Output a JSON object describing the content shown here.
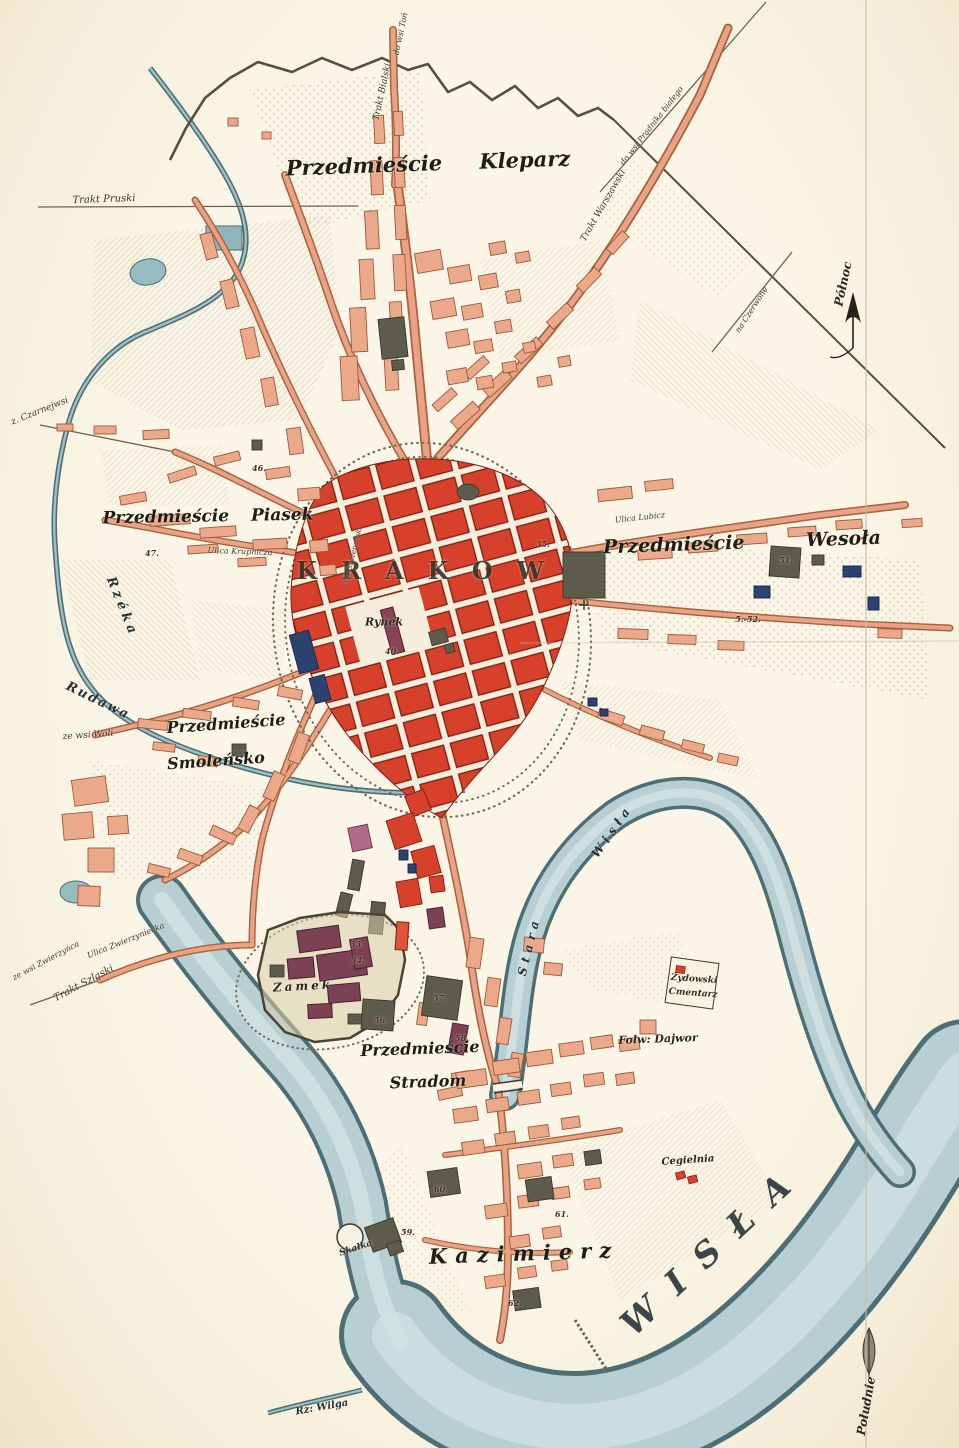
{
  "map_type": "historical city plan of Krakow",
  "colors": {
    "paper": "#f8f2df",
    "old_town_block_red": "#d7402a",
    "suburb_block_salmon": "#eca98a",
    "public_building_grey": "#5d5c4c",
    "castle_purple": "#7c4154",
    "special_block_blue": "#2c4370",
    "river_fill": "#b7cfd2",
    "river_edge": "#4c6e74",
    "ink": "#2b2620"
  },
  "compass": {
    "north": "Północ",
    "south": "Południe"
  },
  "labels": [
    {
      "id": "przedmiescie-kleparz",
      "t": "Przedmieście Kleparz",
      "x": 428,
      "y": 163,
      "r": -2,
      "s": 21,
      "ws": 30,
      "c": "district"
    },
    {
      "id": "przedmiescie-piasek",
      "t": "Przedmieście Piasek",
      "x": 208,
      "y": 517,
      "r": -1,
      "s": 17,
      "ws": 16,
      "c": "district"
    },
    {
      "id": "przedmiescie-wesola",
      "t": "Przedmieście Wesoła",
      "x": 742,
      "y": 543,
      "r": -2,
      "s": 19,
      "ws": 55,
      "c": "district"
    },
    {
      "id": "krakow",
      "t": "KRAKOW",
      "x": 432,
      "y": 571,
      "r": 0,
      "s": 24,
      "ls": 24,
      "c": "city"
    },
    {
      "id": "rynek",
      "t": "Rynek",
      "x": 384,
      "y": 622,
      "r": 0,
      "s": 11,
      "c": "place"
    },
    {
      "id": "smolensko-line1",
      "t": "Przedmieście",
      "x": 226,
      "y": 724,
      "r": -4,
      "s": 16,
      "c": "district"
    },
    {
      "id": "smolensko-line2",
      "t": "Smoleńsko",
      "x": 216,
      "y": 761,
      "r": -4,
      "s": 16,
      "c": "district"
    },
    {
      "id": "stradom-line1",
      "t": "Przedmieście",
      "x": 420,
      "y": 1049,
      "r": -2,
      "s": 16,
      "c": "district"
    },
    {
      "id": "stradom-line2",
      "t": "Stradom",
      "x": 428,
      "y": 1082,
      "r": -2,
      "s": 16,
      "c": "district"
    },
    {
      "id": "kazimierz",
      "t": "Kazimierz",
      "x": 524,
      "y": 1253,
      "r": -2,
      "s": 21,
      "ls": 8,
      "c": "district"
    },
    {
      "id": "zamek",
      "t": "Zamek",
      "x": 303,
      "y": 986,
      "r": -3,
      "s": 12,
      "ls": 3,
      "c": "place"
    },
    {
      "id": "wisla",
      "t": "WISŁA",
      "x": 714,
      "y": 1248,
      "r": -43,
      "s": 34,
      "ls": 22,
      "c": "bigriver"
    },
    {
      "id": "stara-wisla-1",
      "t": "Stara",
      "x": 529,
      "y": 946,
      "r": -76,
      "s": 12,
      "ls": 5,
      "c": "river"
    },
    {
      "id": "stara-wisla-2",
      "t": "Wisła",
      "x": 612,
      "y": 831,
      "r": -55,
      "s": 12,
      "ls": 5,
      "c": "river"
    },
    {
      "id": "rzeka",
      "t": "Rzéka",
      "x": 122,
      "y": 607,
      "r": 68,
      "s": 13,
      "ls": 4,
      "c": "river"
    },
    {
      "id": "rudawa",
      "t": "Rudawa",
      "x": 98,
      "y": 701,
      "r": 26,
      "s": 13,
      "ls": 2,
      "c": "river"
    },
    {
      "id": "rz-wilga",
      "t": "Rz: Wilga",
      "x": 322,
      "y": 1408,
      "r": -10,
      "s": 10,
      "c": "river"
    },
    {
      "id": "polnoc",
      "t": "Północ",
      "x": 843,
      "y": 284,
      "r": -78,
      "s": 12,
      "c": "place"
    },
    {
      "id": "poludnie",
      "t": "Południe",
      "x": 866,
      "y": 1406,
      "r": -80,
      "s": 12,
      "c": "place"
    },
    {
      "id": "trakt-pruski",
      "t": "Trakt Pruski",
      "x": 104,
      "y": 200,
      "r": -2,
      "s": 10,
      "c": "road"
    },
    {
      "id": "trakt-bialski",
      "t": "Trakt Bialski",
      "x": 383,
      "y": 92,
      "r": -78,
      "s": 9,
      "c": "road"
    },
    {
      "id": "do-wsi-ton",
      "t": "do wsi Toń",
      "x": 401,
      "y": 34,
      "r": -78,
      "s": 8,
      "c": "road"
    },
    {
      "id": "do-wsi-pradnika",
      "t": "do wsi Prądnika białego",
      "x": 652,
      "y": 126,
      "r": -52,
      "s": 8,
      "c": "road"
    },
    {
      "id": "trakt-warszawski",
      "t": "Trakt Warszawski",
      "x": 604,
      "y": 206,
      "r": -60,
      "s": 9,
      "c": "road"
    },
    {
      "id": "na-czerwone",
      "t": "na Czerwone",
      "x": 752,
      "y": 310,
      "r": -57,
      "s": 8,
      "c": "road"
    },
    {
      "id": "z-czarnejwsi",
      "t": "z. Czarnejwsi",
      "x": 40,
      "y": 412,
      "r": -22,
      "s": 9,
      "c": "road"
    },
    {
      "id": "ze-wsi-woli",
      "t": "ze wsi Woli",
      "x": 88,
      "y": 736,
      "r": -4,
      "s": 9,
      "c": "road"
    },
    {
      "id": "ze-wsi-zwierzynca",
      "t": "ze wsi Zwierzyńca",
      "x": 46,
      "y": 961,
      "r": -28,
      "s": 8,
      "c": "road"
    },
    {
      "id": "trakt-szlaski",
      "t": "Trakt Szląski",
      "x": 84,
      "y": 984,
      "r": -28,
      "s": 10,
      "c": "road"
    },
    {
      "id": "ulica-zwierzyniecka",
      "t": "Ulica Zwierzyniecka",
      "x": 126,
      "y": 941,
      "r": -22,
      "s": 8,
      "c": "road"
    },
    {
      "id": "ulica-lubicz",
      "t": "Ulica Lubicz",
      "x": 640,
      "y": 518,
      "r": -6,
      "s": 8,
      "c": "road"
    },
    {
      "id": "ulica-krupnicza",
      "t": "Ulica Krupnicza",
      "x": 240,
      "y": 552,
      "r": 2,
      "s": 8,
      "c": "road"
    },
    {
      "id": "plac-szczepanski",
      "t": "Plac Szczepański",
      "x": 353,
      "y": 557,
      "r": -76,
      "s": 7,
      "c": "road"
    },
    {
      "id": "zydowski-cmentarz-1",
      "t": "Żydowski",
      "x": 694,
      "y": 980,
      "r": 4,
      "s": 9,
      "c": "small"
    },
    {
      "id": "zydowski-cmentarz-2",
      "t": "Cmentarz",
      "x": 693,
      "y": 994,
      "r": 4,
      "s": 9,
      "c": "small"
    },
    {
      "id": "folw-dajwor",
      "t": "Folw: Dajwor",
      "x": 658,
      "y": 1039,
      "r": -2,
      "s": 11,
      "c": "place"
    },
    {
      "id": "cegielnia",
      "t": "Cegielnia",
      "x": 688,
      "y": 1161,
      "r": -4,
      "s": 10,
      "c": "place"
    },
    {
      "id": "skalka",
      "t": "Skałka",
      "x": 356,
      "y": 1249,
      "r": -18,
      "s": 9,
      "c": "small"
    }
  ],
  "numbers": [
    {
      "n": "35.",
      "x": 543,
      "y": 544
    },
    {
      "n": "40.",
      "x": 392,
      "y": 651
    },
    {
      "n": "46.",
      "x": 259,
      "y": 468
    },
    {
      "n": "47.",
      "x": 152,
      "y": 553
    },
    {
      "n": "51.",
      "x": 786,
      "y": 560
    },
    {
      "n": "5.-52.",
      "x": 748,
      "y": 619
    },
    {
      "n": "33.",
      "x": 357,
      "y": 944
    },
    {
      "n": "34.",
      "x": 358,
      "y": 960
    },
    {
      "n": "56.",
      "x": 381,
      "y": 1020
    },
    {
      "n": "57.",
      "x": 440,
      "y": 998
    },
    {
      "n": "58.",
      "x": 462,
      "y": 1038
    },
    {
      "n": "59.",
      "x": 408,
      "y": 1232
    },
    {
      "n": "60.",
      "x": 441,
      "y": 1189
    },
    {
      "n": "61.",
      "x": 562,
      "y": 1214
    },
    {
      "n": "62.",
      "x": 515,
      "y": 1303
    }
  ]
}
